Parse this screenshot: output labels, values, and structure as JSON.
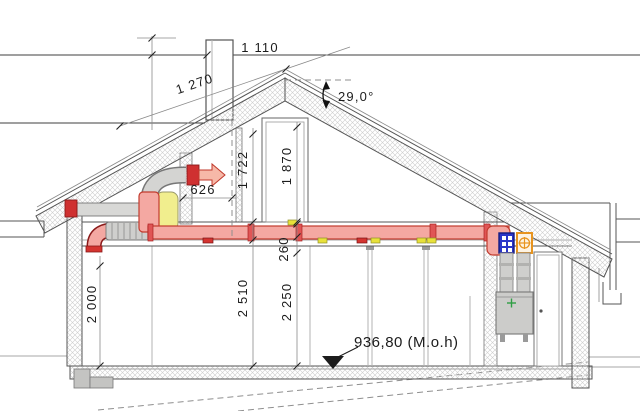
{
  "drawing": {
    "title": "house-cross-section-ventilation",
    "dims": {
      "d1110": "1 110",
      "d1270": "1 270",
      "d626": "626",
      "d1722": "1 722",
      "d1870": "1 870",
      "d2000": "2 000",
      "d260": "260",
      "d2510": "2 510",
      "d2250": "2 250"
    },
    "angle_label": "29,0°",
    "level_label": "936,80 (M.o.h)",
    "colors": {
      "duct_fill": "#f4a8a2",
      "duct_outline": "#c23b2e",
      "silencer": "#f1ee8e",
      "supply_symbol_blue": "#2a35c8",
      "extract_symbol_orange": "#e8941e",
      "unit_plus_green": "#2f9e44",
      "damper_yellow": "#e8e13a",
      "damper_red": "#d43430"
    }
  }
}
